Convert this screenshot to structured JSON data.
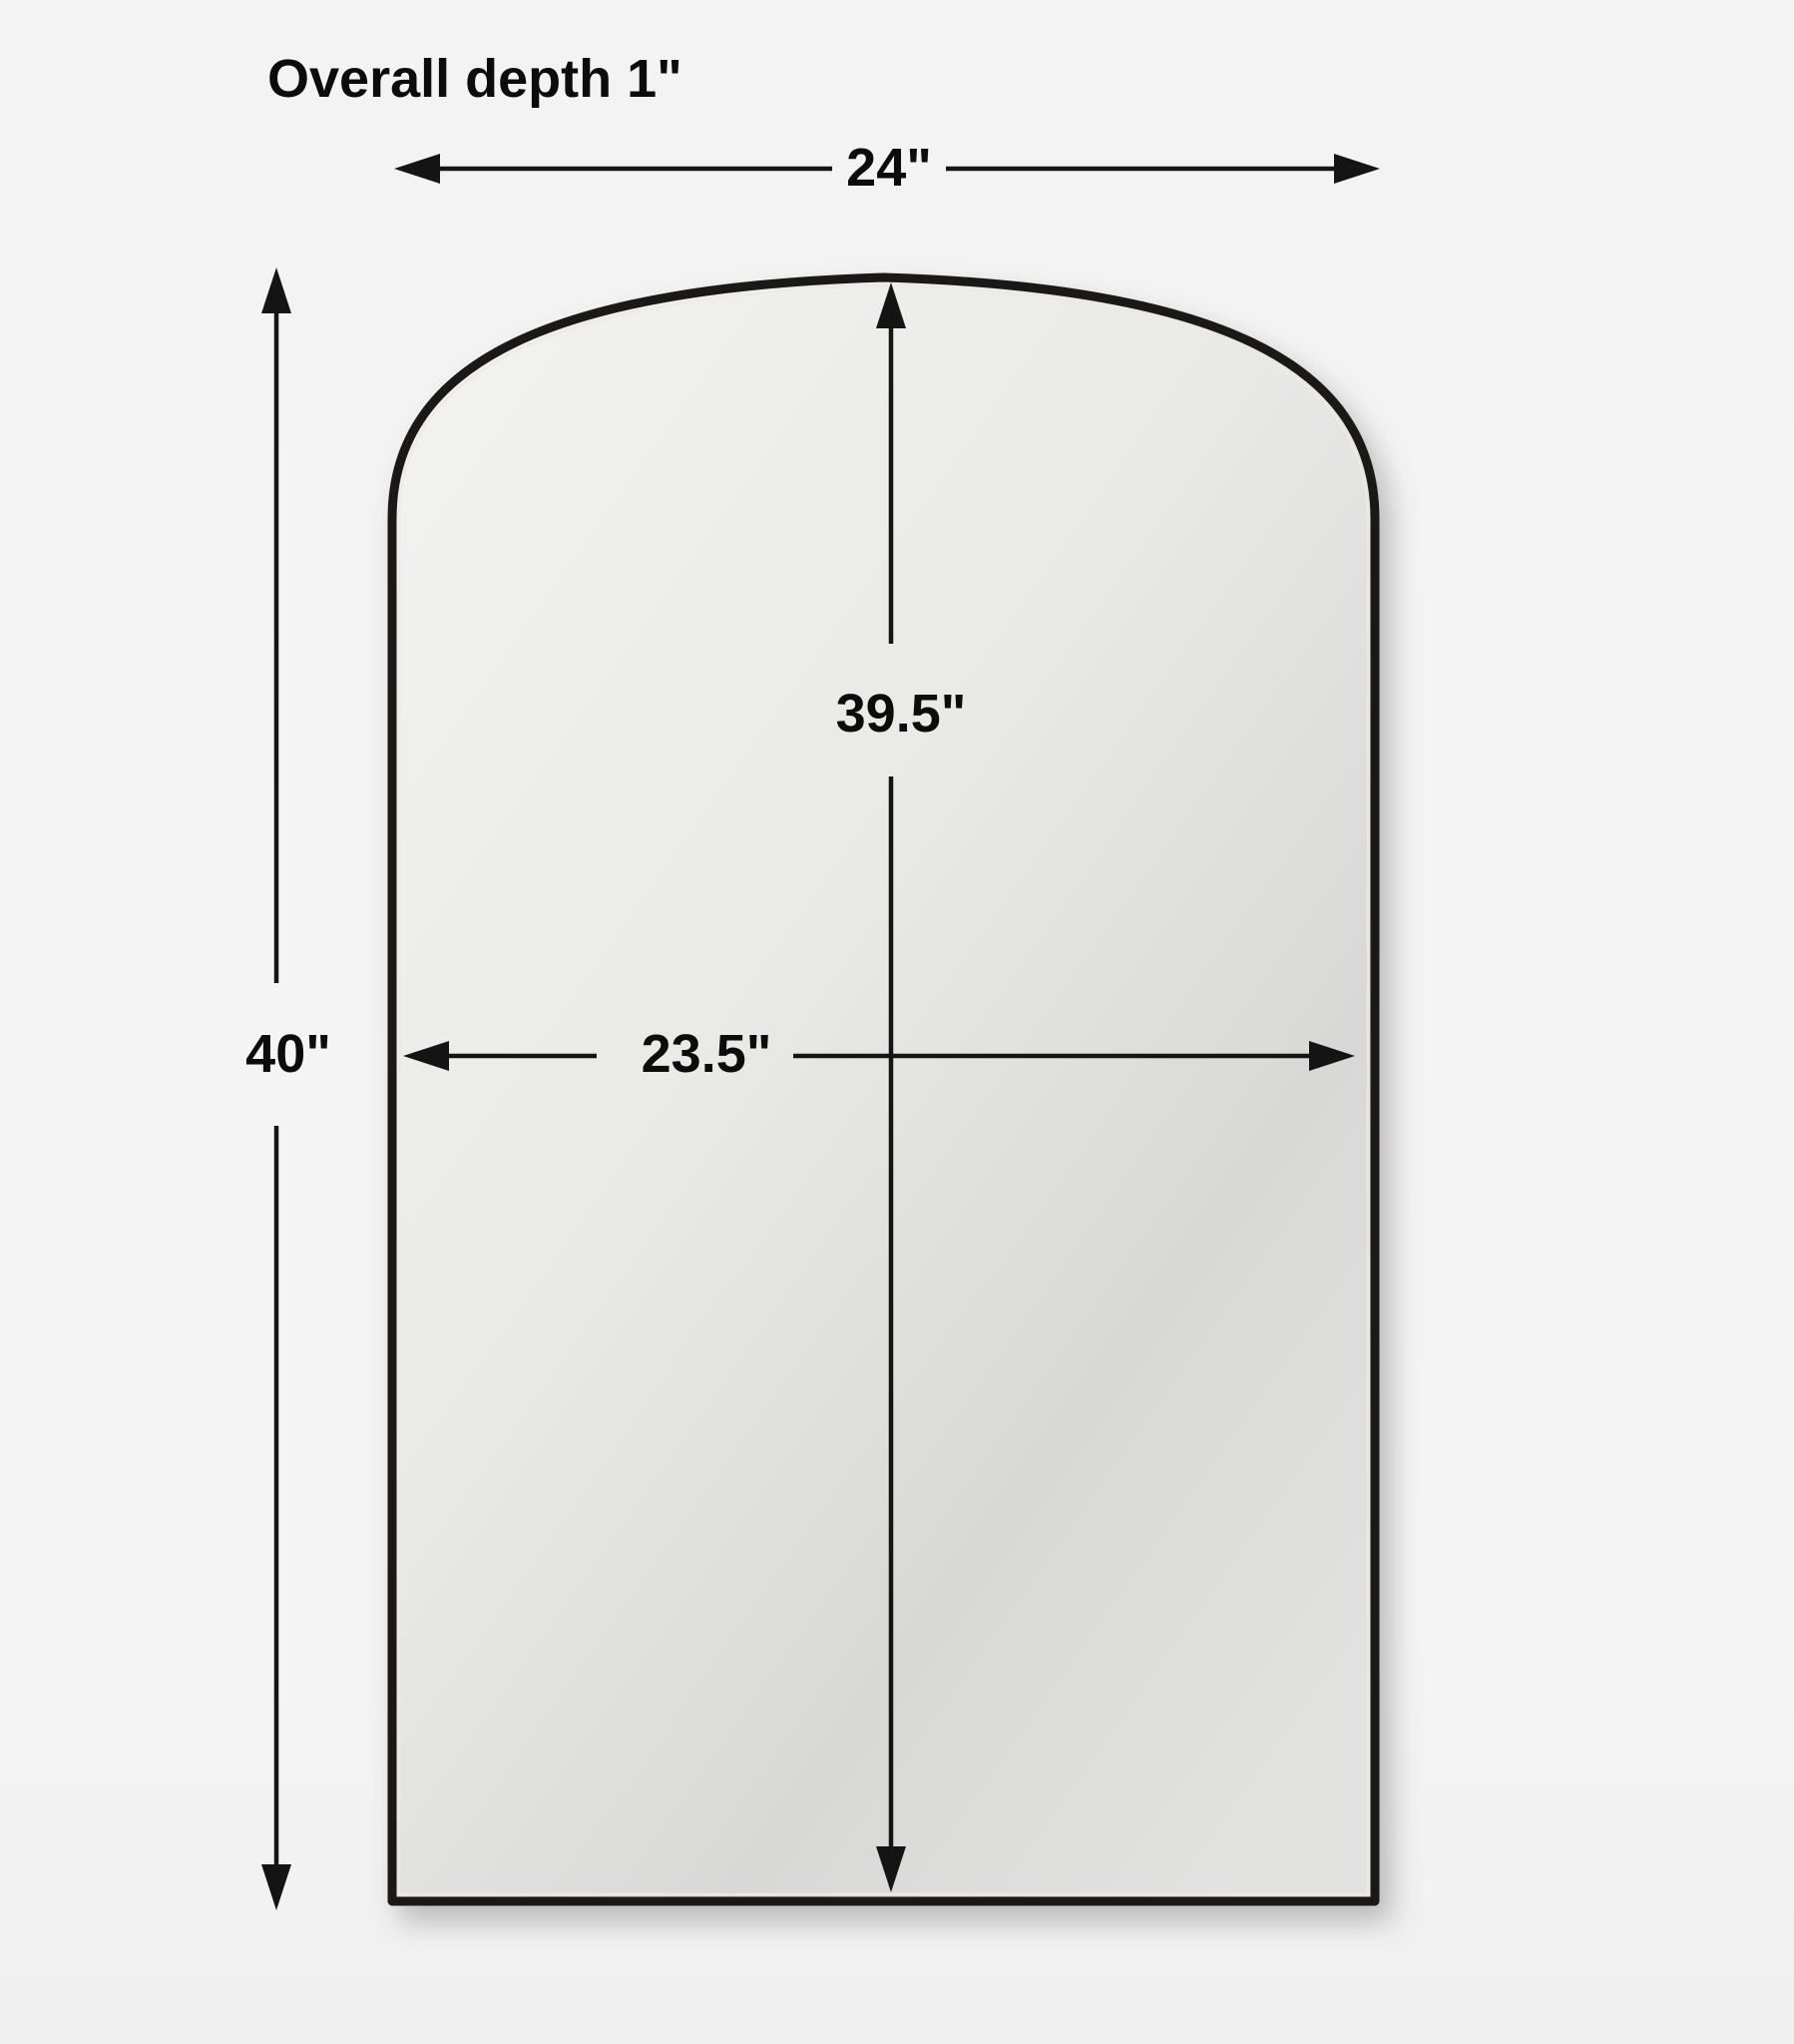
{
  "diagram": {
    "product": "arched wall mirror dimension diagram",
    "labels": {
      "overall_depth": "Overall depth 1\"",
      "overall_width": "24\"",
      "overall_height": "40\"",
      "mirror_height": "39.5\"",
      "mirror_width": "23.5\""
    },
    "measurements": {
      "overall_depth_in": 1,
      "overall_width_in": 24,
      "overall_height_in": 40,
      "mirror_height_in": 39.5,
      "mirror_width_in": 23.5
    },
    "colors": {
      "background": "#f4f4f4",
      "dimension_line": "#141414",
      "text": "#0c0c0c",
      "frame": "#1b1916",
      "glass_light": "#f2f2f1",
      "glass_dark": "#d6d6d4"
    }
  }
}
